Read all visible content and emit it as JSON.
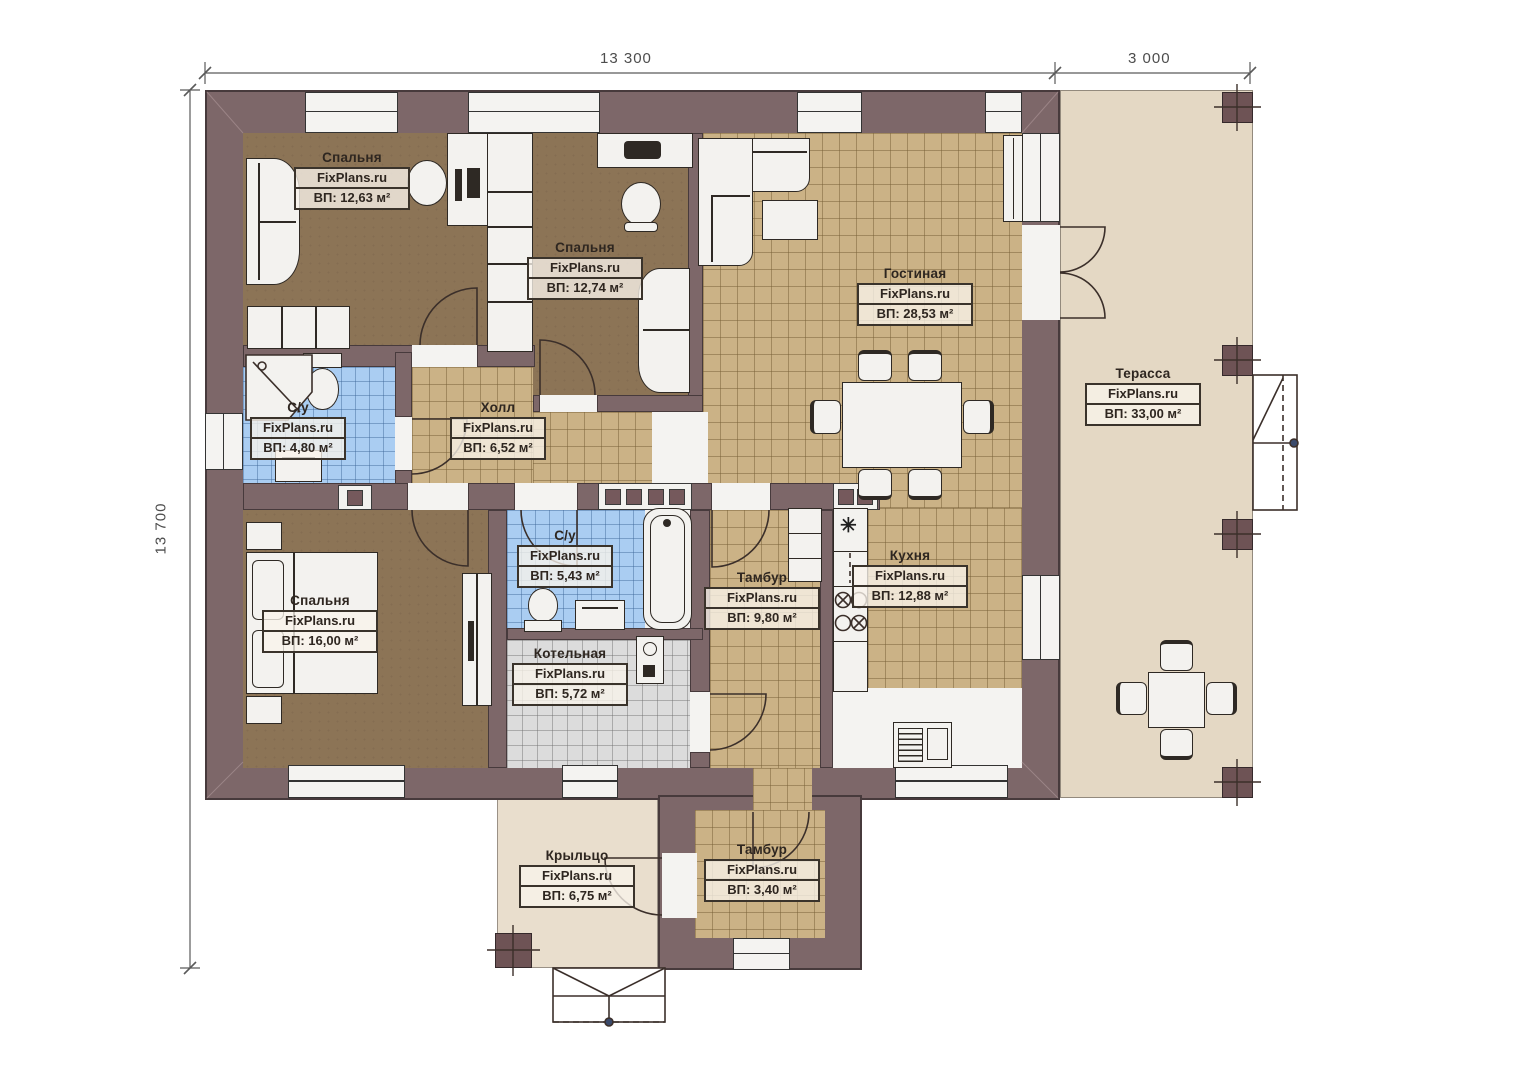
{
  "watermark": "FixPlans.ru",
  "dimensions": {
    "width_main": "13 300",
    "width_terrace": "3 000",
    "height": "13 700"
  },
  "rooms": [
    {
      "id": "bedroom-1",
      "name": "Спальня",
      "area": "ВП: 12,63 м²"
    },
    {
      "id": "bedroom-2",
      "name": "Спальня",
      "area": "ВП: 12,74 м²"
    },
    {
      "id": "living-room",
      "name": "Гостиная",
      "area": "ВП: 28,53 м²"
    },
    {
      "id": "terrace",
      "name": "Терасса",
      "area": "ВП: 33,00 м²"
    },
    {
      "id": "bathroom-1",
      "name": "С/у",
      "area": "ВП: 4,80 м²"
    },
    {
      "id": "hall",
      "name": "Холл",
      "area": "ВП: 6,52 м²"
    },
    {
      "id": "bedroom-3",
      "name": "Спальня",
      "area": "ВП: 16,00 м²"
    },
    {
      "id": "bathroom-2",
      "name": "С/у",
      "area": "ВП: 5,43 м²"
    },
    {
      "id": "boiler-room",
      "name": "Котельная",
      "area": "ВП: 5,72 м²"
    },
    {
      "id": "vestibule-1",
      "name": "Тамбур",
      "area": "ВП: 9,80 м²"
    },
    {
      "id": "kitchen",
      "name": "Кухня",
      "area": "ВП: 12,88 м²"
    },
    {
      "id": "porch",
      "name": "Крыльцо",
      "area": "ВП: 6,75 м²"
    },
    {
      "id": "vestibule-2",
      "name": "Тамбур",
      "area": "ВП: 3,40 м²"
    }
  ],
  "colors": {
    "wall": "#7d6769",
    "wood_floor": "#8c7456",
    "tile_beige": "#cbb286",
    "tile_blue": "#aacdf2",
    "tile_gray": "#dcdcdc",
    "terrace": "#e4d8c4"
  }
}
